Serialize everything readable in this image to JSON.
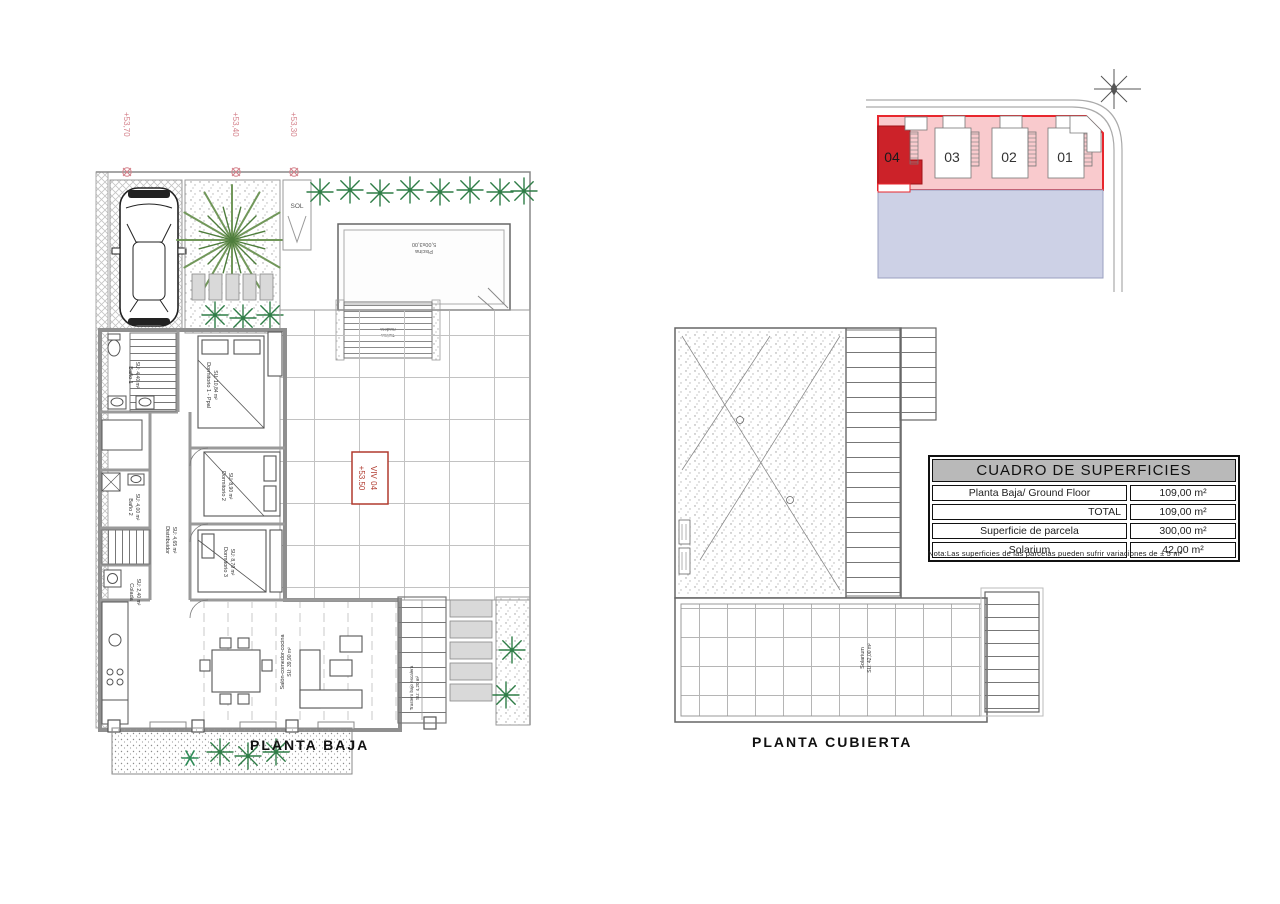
{
  "sheet": {
    "background": "#ffffff"
  },
  "site_plan": {
    "plots": [
      "04",
      "03",
      "02",
      "01"
    ],
    "highlighted_plot": "04",
    "colors": {
      "band": "#f9cacd",
      "highlight": "#cc2229",
      "outline": "#e8262d",
      "ground": "#cdd1e6"
    }
  },
  "ground_floor": {
    "title": "PLANTA BAJA",
    "elevation_labels": [
      "+53,70",
      "+53,40",
      "+53,30"
    ],
    "viv_marker": {
      "line1": "VIV 04",
      "line2": "+53.50"
    },
    "sol_label": "SOL",
    "pool_label": {
      "line1": "Piscina",
      "line2": "5,00x3,00"
    },
    "deck_label": {
      "line1": "Tarima",
      "line2": "madera"
    },
    "rooms": [
      {
        "name": "Baño 1",
        "area": "SU: 4,40 m²"
      },
      {
        "name": "Dormitorio 1 - Ppal",
        "area": "SU: 10,84 m²"
      },
      {
        "name": "Dormitorio 2",
        "area": "SU: 8,90 m²"
      },
      {
        "name": "Dormitorio 3",
        "area": "SU: 8,70 m²"
      },
      {
        "name": "Baño 2",
        "area": "SU: 4,00 m²"
      },
      {
        "name": "Colada",
        "area": "SU: 2,40 m²"
      },
      {
        "name": "Distribuidor",
        "area": "SU: 4,65 m²"
      },
      {
        "name": "Salón-comedor-cocina",
        "area": "SU: 39,90 m²"
      },
      {
        "name": "Trastero bajo escalera",
        "area": "SU: 4,20 m²"
      }
    ]
  },
  "roof_plan": {
    "title": "PLANTA CUBIERTA",
    "solarium": {
      "name": "Solarium",
      "area": "SU: 42,00 m²"
    }
  },
  "surface_table": {
    "title": "CUADRO DE SUPERFICIES",
    "rows": [
      {
        "label": "Planta Baja/ Ground Floor",
        "value": "109,00 m²"
      },
      {
        "label": "TOTAL",
        "value": "109,00 m²"
      },
      {
        "label": "Superficie de parcela",
        "value": "300,00 m²"
      },
      {
        "label": "Solarium",
        "value": "42,00 m²"
      }
    ],
    "note": "Nota:Las superficies de las parcelas pueden sufrir variaciones de ± 5 m²"
  }
}
